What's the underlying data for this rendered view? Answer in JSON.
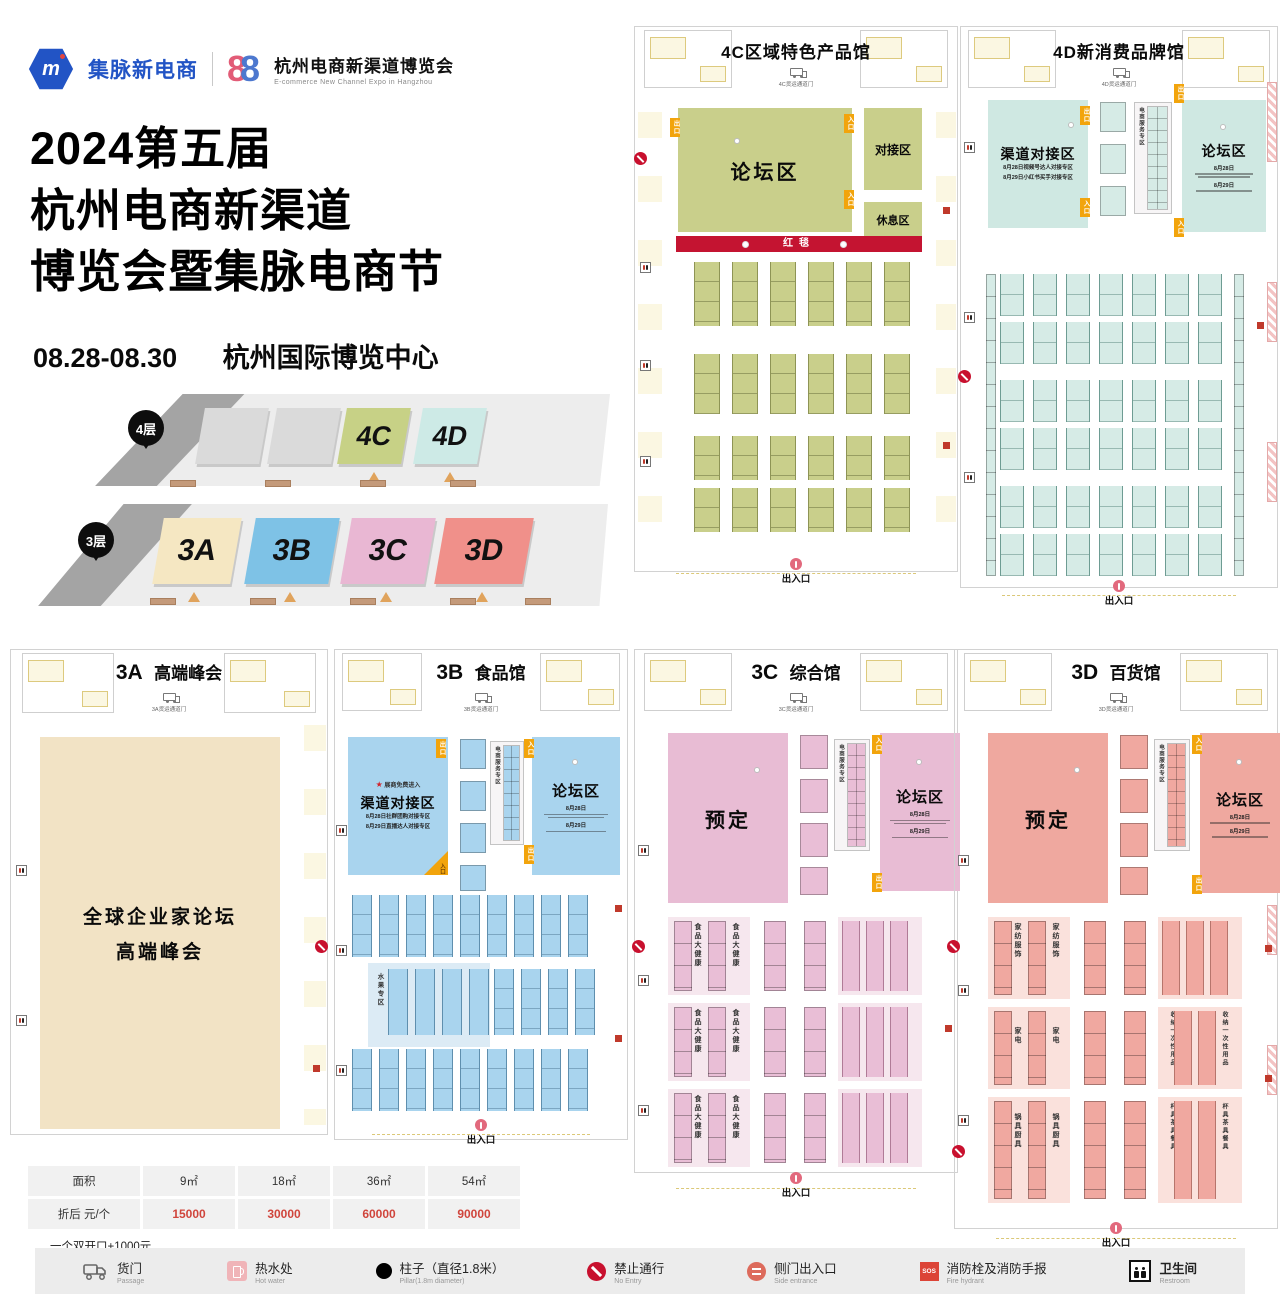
{
  "brand": {
    "logo_text": "集脉新电商",
    "logo_mark": "m",
    "eight_left": "8",
    "eight_right": "8",
    "expo_cn": "杭州电商新渠道博览会",
    "expo_en": "E-commerce New Channel  Expo in Hangzhou",
    "title_line1": "2024第五届",
    "title_line2": "杭州电商新渠道",
    "title_line3": "博览会暨集脉电商节",
    "date": "08.28-08.30",
    "venue": "杭州国际博览中心"
  },
  "overview": {
    "floor4_label": "4层",
    "floor3_label": "3层",
    "hall_4c": "4C",
    "hall_4d": "4D",
    "hall_3a": "3A",
    "hall_3b": "3B",
    "hall_3c": "3C",
    "hall_3d": "3D"
  },
  "tags": {
    "exit": "出口",
    "entry": "入口",
    "gate": "出入口"
  },
  "halls": {
    "h4c": {
      "title": "4C区域特色产品馆",
      "truck_gate": "4C货运通道门",
      "forum": "论坛区",
      "matching": "对接区",
      "rest": "休息区",
      "red_carpet": "红毯"
    },
    "h4d": {
      "title": "4D新消费品牌馆",
      "truck_gate": "4D货运通道门",
      "channel_zone": "渠道对接区",
      "channel_sub1": "8月28日视频号达人对接专区",
      "channel_sub2": "8月29日小红书买手对接专区",
      "service_zone": "电商服务专区",
      "forum": "论坛区",
      "forum_sub1": "8月28日",
      "forum_sub2": "8月29日"
    },
    "h3a": {
      "title_no": "3A",
      "title_name": "高端峰会",
      "truck_gate": "3A货运通道门",
      "main_line1": "全球企业家论坛",
      "main_line2": "高端峰会"
    },
    "h3b": {
      "title_no": "3B",
      "title_name": "食品馆",
      "truck_gate": "3B货运通道门",
      "star_note": "展商免费进入",
      "channel_zone": "渠道对接区",
      "channel_sub1": "8月28日社群团购对接专区",
      "channel_sub2": "8月29日直播达人对接专区",
      "service_zone": "电商服务专区",
      "forum": "论坛区",
      "forum_sub1": "8月28日",
      "forum_sub2": "8月29日",
      "fruit_zone": "水果专区"
    },
    "h3c": {
      "title_no": "3C",
      "title_name": "综合馆",
      "truck_gate": "3C货运通道门",
      "reserved": "预定",
      "service_zone": "电商服务专区",
      "forum": "论坛区",
      "forum_sub1": "8月28日",
      "forum_sub2": "8月29日",
      "zone_food": "食品大健康",
      "zone_baby": "孕婴童"
    },
    "h3d": {
      "title_no": "3D",
      "title_name": "百货馆",
      "truck_gate": "3D货运通道门",
      "reserved": "预定",
      "service_zone": "电商服务专区",
      "forum": "论坛区",
      "forum_sub1": "8月28日",
      "forum_sub2": "8月29日",
      "zone_textile": "家纺服饰",
      "zone_outdoor": "运动户外",
      "zone_appliance": "家电",
      "zone_storage": "收纳一次性用品",
      "zone_cookware": "锅具厨具",
      "zone_tableware": "杯具茶具餐具"
    }
  },
  "price_table": {
    "headers": [
      "面积",
      "9㎡",
      "18㎡",
      "36㎡",
      "54㎡"
    ],
    "row_label": "折后 元/个",
    "prices": [
      "15000",
      "30000",
      "60000",
      "90000"
    ],
    "note": "一个双开口+1000元"
  },
  "legend": {
    "sos": "SOS",
    "items": [
      {
        "cn": "货门",
        "en": "Passage"
      },
      {
        "cn": "热水处",
        "en": "Hot water"
      },
      {
        "cn": "柱子（直径1.8米）",
        "en": "Pillar(1.8m diameter)"
      },
      {
        "cn": "禁止通行",
        "en": "No Entry"
      },
      {
        "cn": "侧门出入口",
        "en": "Side entrance"
      },
      {
        "cn": "消防栓及消防手报",
        "en": "Fire hydrant"
      },
      {
        "cn": "卫生间",
        "en": "Restroom"
      }
    ]
  }
}
